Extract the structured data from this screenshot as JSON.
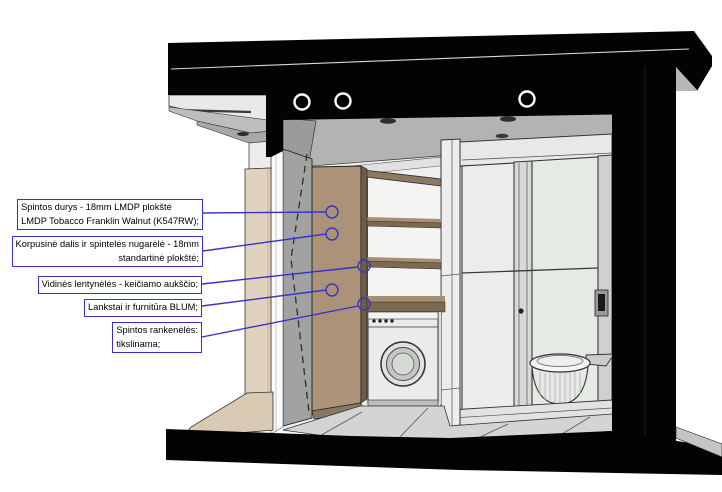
{
  "drawing": {
    "type": "interior elevation section",
    "subject": "bathroom built-in wardrobe specification drawing",
    "colors": {
      "annotation_blue": "#3333cc",
      "section_cut_black": "#030303",
      "wardrobe_door_walnut": "#ac9279",
      "shelf_walnut": "#7c6950",
      "wall_beige": "#e0d2bc",
      "floor_tile_gray": "#d4d4d4"
    },
    "labels": [
      {
        "id": "door-material",
        "lines": [
          "Spintos durys - 18mm LMDP plokštė",
          "LMDP Tobacco Franklin Walnut (K547RW);"
        ],
        "align": "left"
      },
      {
        "id": "carcass-back-panel",
        "lines": [
          "Korpusinė dalis ir spintelės nugarėlė - 18mm",
          "standartinė plokštė;"
        ],
        "align": "right"
      },
      {
        "id": "inner-shelves",
        "lines": [
          "Vidinės lentynėlės - keičiamo aukščio;"
        ],
        "align": "left"
      },
      {
        "id": "hinges-hardware",
        "lines": [
          "Lankstai ir furnitūra BLUM;"
        ],
        "align": "left"
      },
      {
        "id": "handles",
        "lines": [
          "Spintos rankenėlės:",
          "tikslinama;"
        ],
        "align": "left"
      }
    ]
  }
}
